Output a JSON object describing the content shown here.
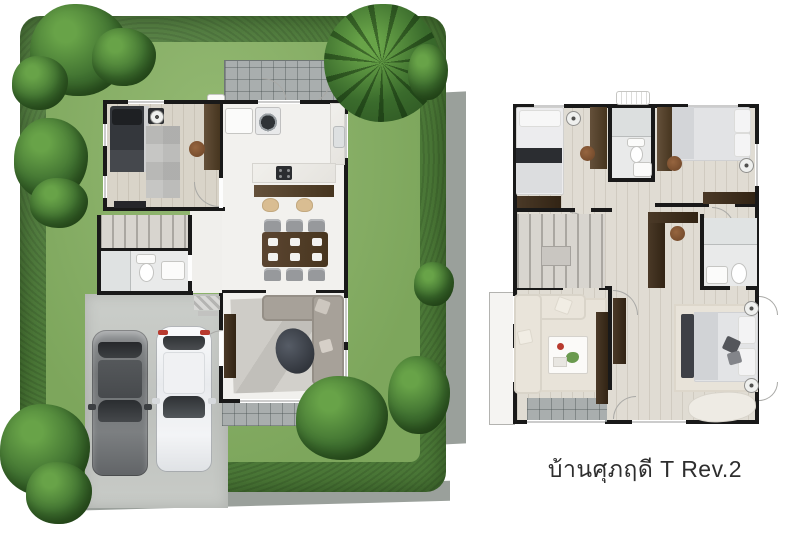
{
  "caption": {
    "text": "บ้านศุภฤดี T Rev.2"
  },
  "scene": {
    "type": "architectural-floor-plans",
    "ground_floor": {
      "rooms": [
        "bedroom",
        "bathroom",
        "kitchen",
        "dining-area",
        "living-room",
        "stairs",
        "garage-driveway",
        "patio",
        "rear-terrace",
        "garden"
      ],
      "vehicles": [
        "gray-sedan",
        "white-suv"
      ]
    },
    "second_floor": {
      "rooms": [
        "bedroom-2",
        "shared-bathroom",
        "bedroom-3",
        "hall-study",
        "master-bathroom",
        "master-bedroom",
        "family-area",
        "stairs",
        "balcony",
        "terrace"
      ]
    }
  },
  "colors": {
    "wall": "#191919",
    "hedge": "#4c7938",
    "lawn": "#7da65c",
    "lawn-light": "#95ba74",
    "tree": "#3f7030",
    "tree-light": "#68a348",
    "tree-dark": "#2b5120",
    "palm": "#3a6b2c",
    "sidewalk": "#9aa09b",
    "concrete": "#c7cac6",
    "tile": "#a9aeae",
    "wood-floor": "#d9d4c9",
    "floor-upper": "#e0dcd3",
    "white-floor": "#f2f1ee",
    "sofa-gray": "#a7a199",
    "sofa-cream": "#e9e4da",
    "rug-gray": "#c9c7c2",
    "rug-beige": "#e8e3d9",
    "bed-dark": "#34373c",
    "bed-white": "#ececee",
    "ottoman": "#424750",
    "car-dark": "#707376",
    "car-white": "#f4f5f6",
    "red": "#b83a2e",
    "stool": "#d9bd92",
    "chair-brown": "#7c5234",
    "arc": "#a9a9a6",
    "text": "#2e2e2e"
  }
}
